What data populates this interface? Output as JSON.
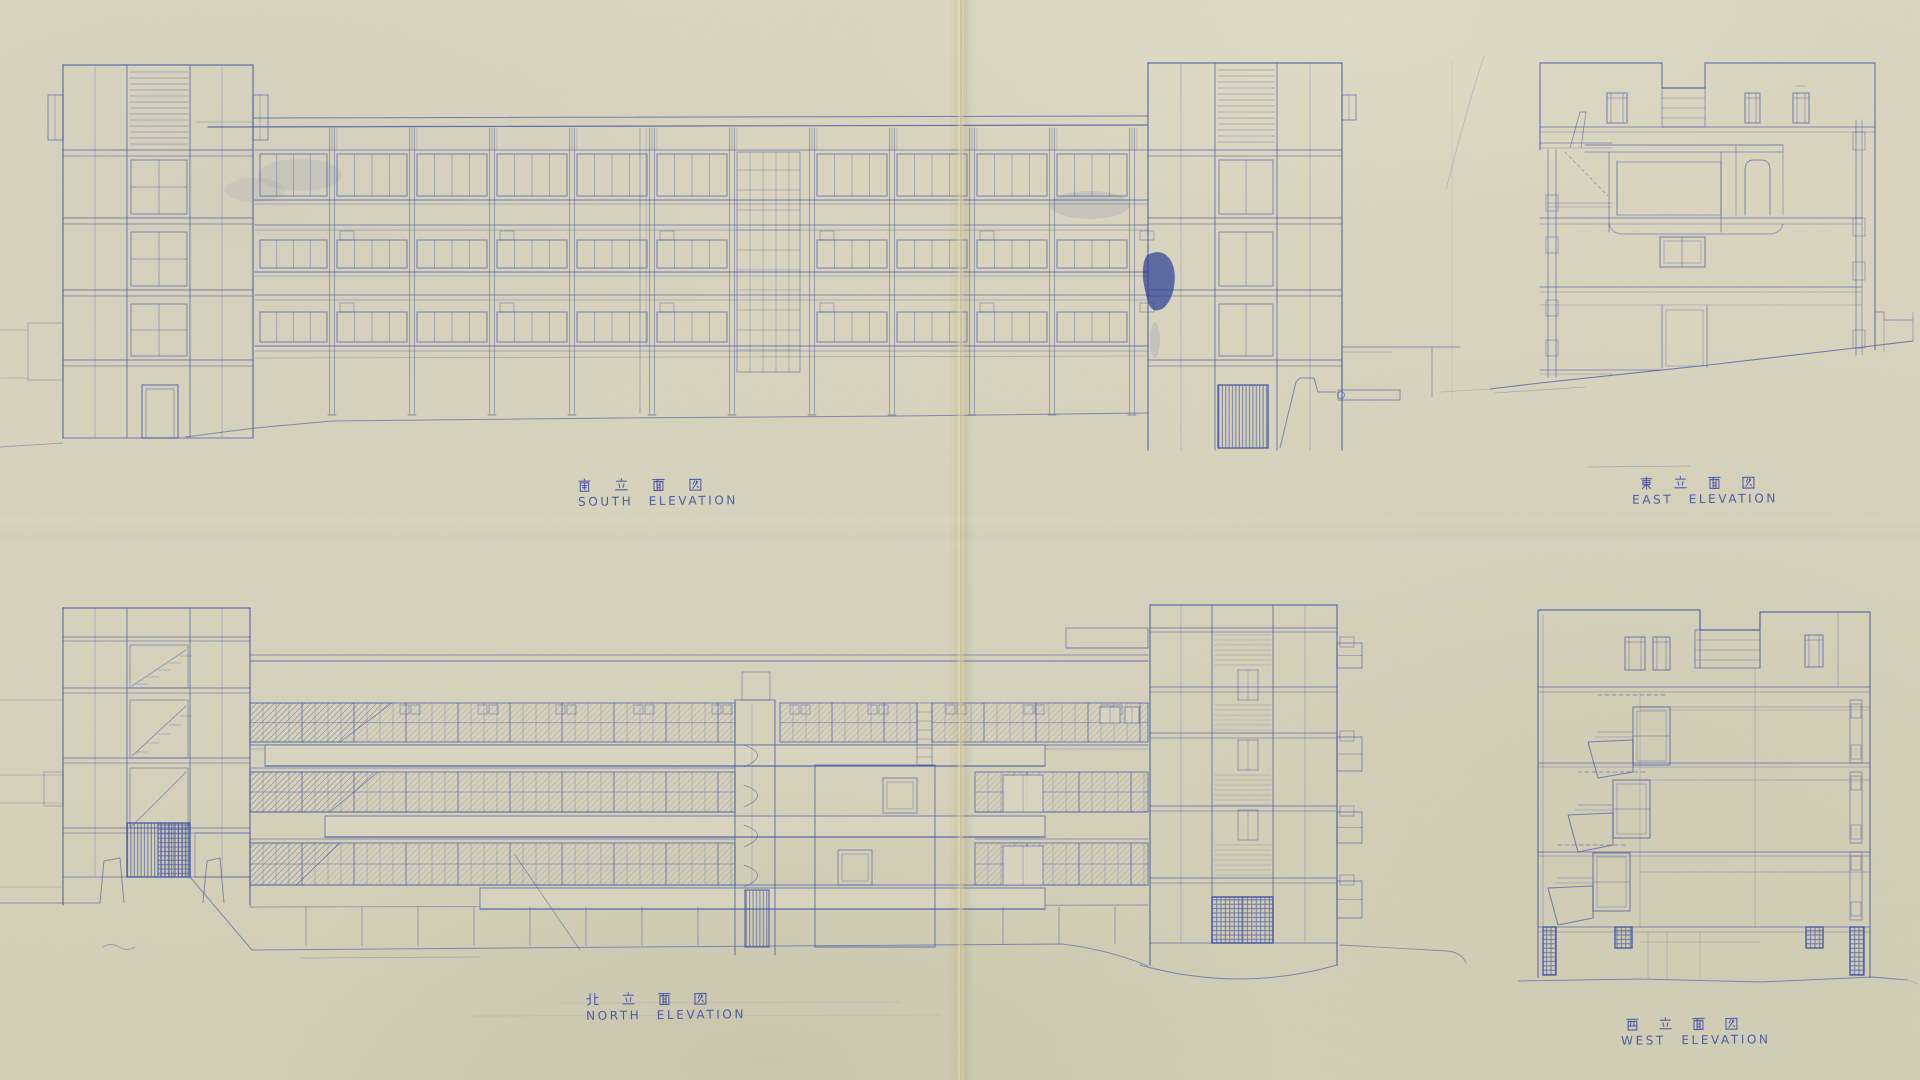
{
  "sheet": {
    "paper_color": "#d8d4be",
    "ink_color": "#4456a6",
    "ink_dark_color": "#2e4095"
  },
  "elevations": [
    {
      "id": "south",
      "kanji_label": "南立面図",
      "en_label": "SOUTH ELEVATION"
    },
    {
      "id": "east",
      "kanji_label": "東立面図",
      "en_label": "EAST ELEVATION"
    },
    {
      "id": "north",
      "kanji_label": "北立面図",
      "en_label": "NORTH ELEVATION"
    },
    {
      "id": "west",
      "kanji_label": "西立面図",
      "en_label": "WEST ELEVATION"
    }
  ]
}
